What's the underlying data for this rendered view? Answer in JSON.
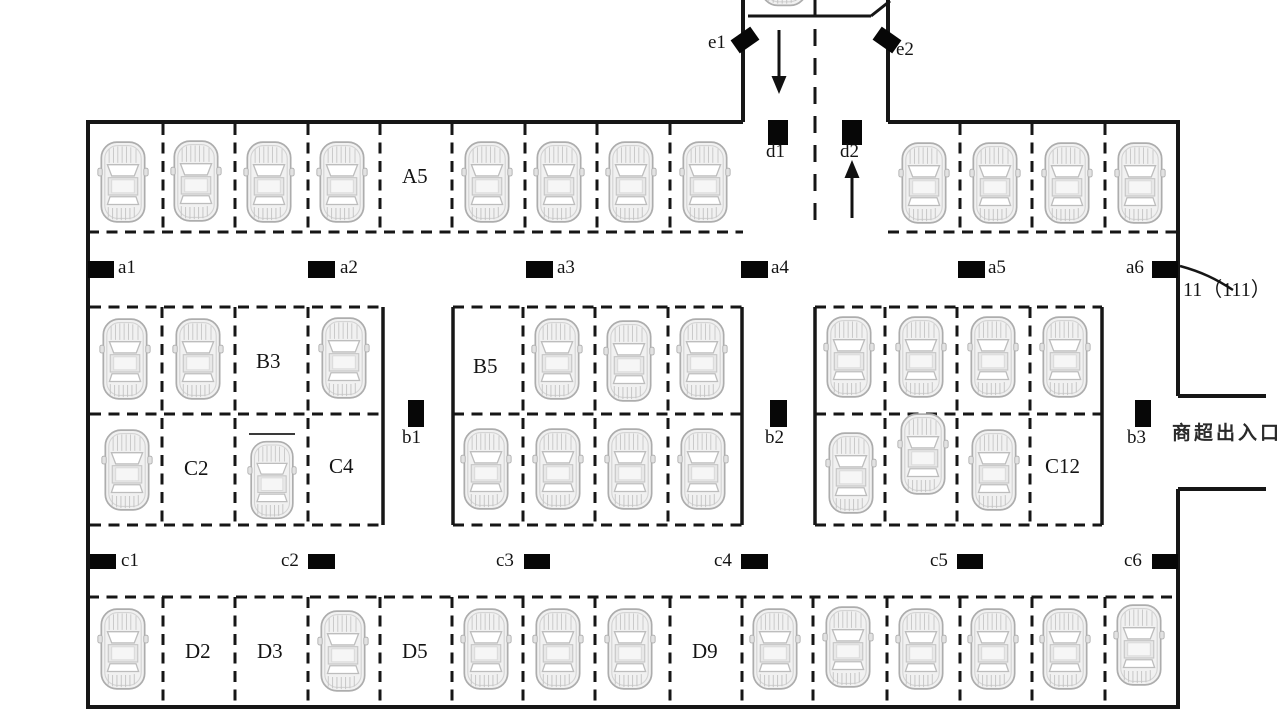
{
  "figure": {
    "type": "underground-parking-lot-floor-plan",
    "description": "Parking lot schematic with entrance lane, parking rows and point sensors"
  },
  "sensors": {
    "a": [
      "a1",
      "a2",
      "a3",
      "a4",
      "a5",
      "a6"
    ],
    "b": [
      "b1",
      "b2",
      "b3"
    ],
    "c": [
      "c1",
      "c2",
      "c3",
      "c4",
      "c5",
      "c6"
    ],
    "d": [
      "d1",
      "d2"
    ],
    "e": [
      "e1",
      "e2"
    ]
  },
  "spaces": {
    "A5": "A5",
    "B3": "B3",
    "B5": "B5",
    "C2": "C2",
    "C4": "C4",
    "C12": "C12",
    "D2": "D2",
    "D3": "D3",
    "D5": "D5",
    "D9": "D9"
  },
  "annotations": {
    "zone_id": "11（111）",
    "mall_entrance": "商超出入口"
  },
  "occupancy": {
    "row_a_left": [
      1,
      1,
      1,
      1,
      0,
      1,
      1,
      1,
      1
    ],
    "row_a_right": [
      1,
      1,
      1,
      1
    ],
    "island1_top": [
      1,
      1,
      0,
      1
    ],
    "island1_bottom": [
      1,
      0,
      1,
      0
    ],
    "island2_top": [
      0,
      1,
      1,
      1
    ],
    "island2_bottom": [
      1,
      1,
      1,
      1
    ],
    "island3_top": [
      1,
      1,
      1,
      1
    ],
    "island3_bottom": [
      1,
      1,
      1,
      0
    ],
    "row_d": [
      1,
      0,
      0,
      1,
      0,
      1,
      1,
      1,
      0,
      1,
      1,
      1,
      1,
      1,
      1
    ]
  },
  "arrows": {
    "entry": "down",
    "exit": "up"
  },
  "colors": {
    "line": "#161616",
    "sensor": "#070707",
    "car_fill": "#f1f1f1",
    "car_stroke": "#b0b0b0",
    "background": "#ffffff"
  }
}
